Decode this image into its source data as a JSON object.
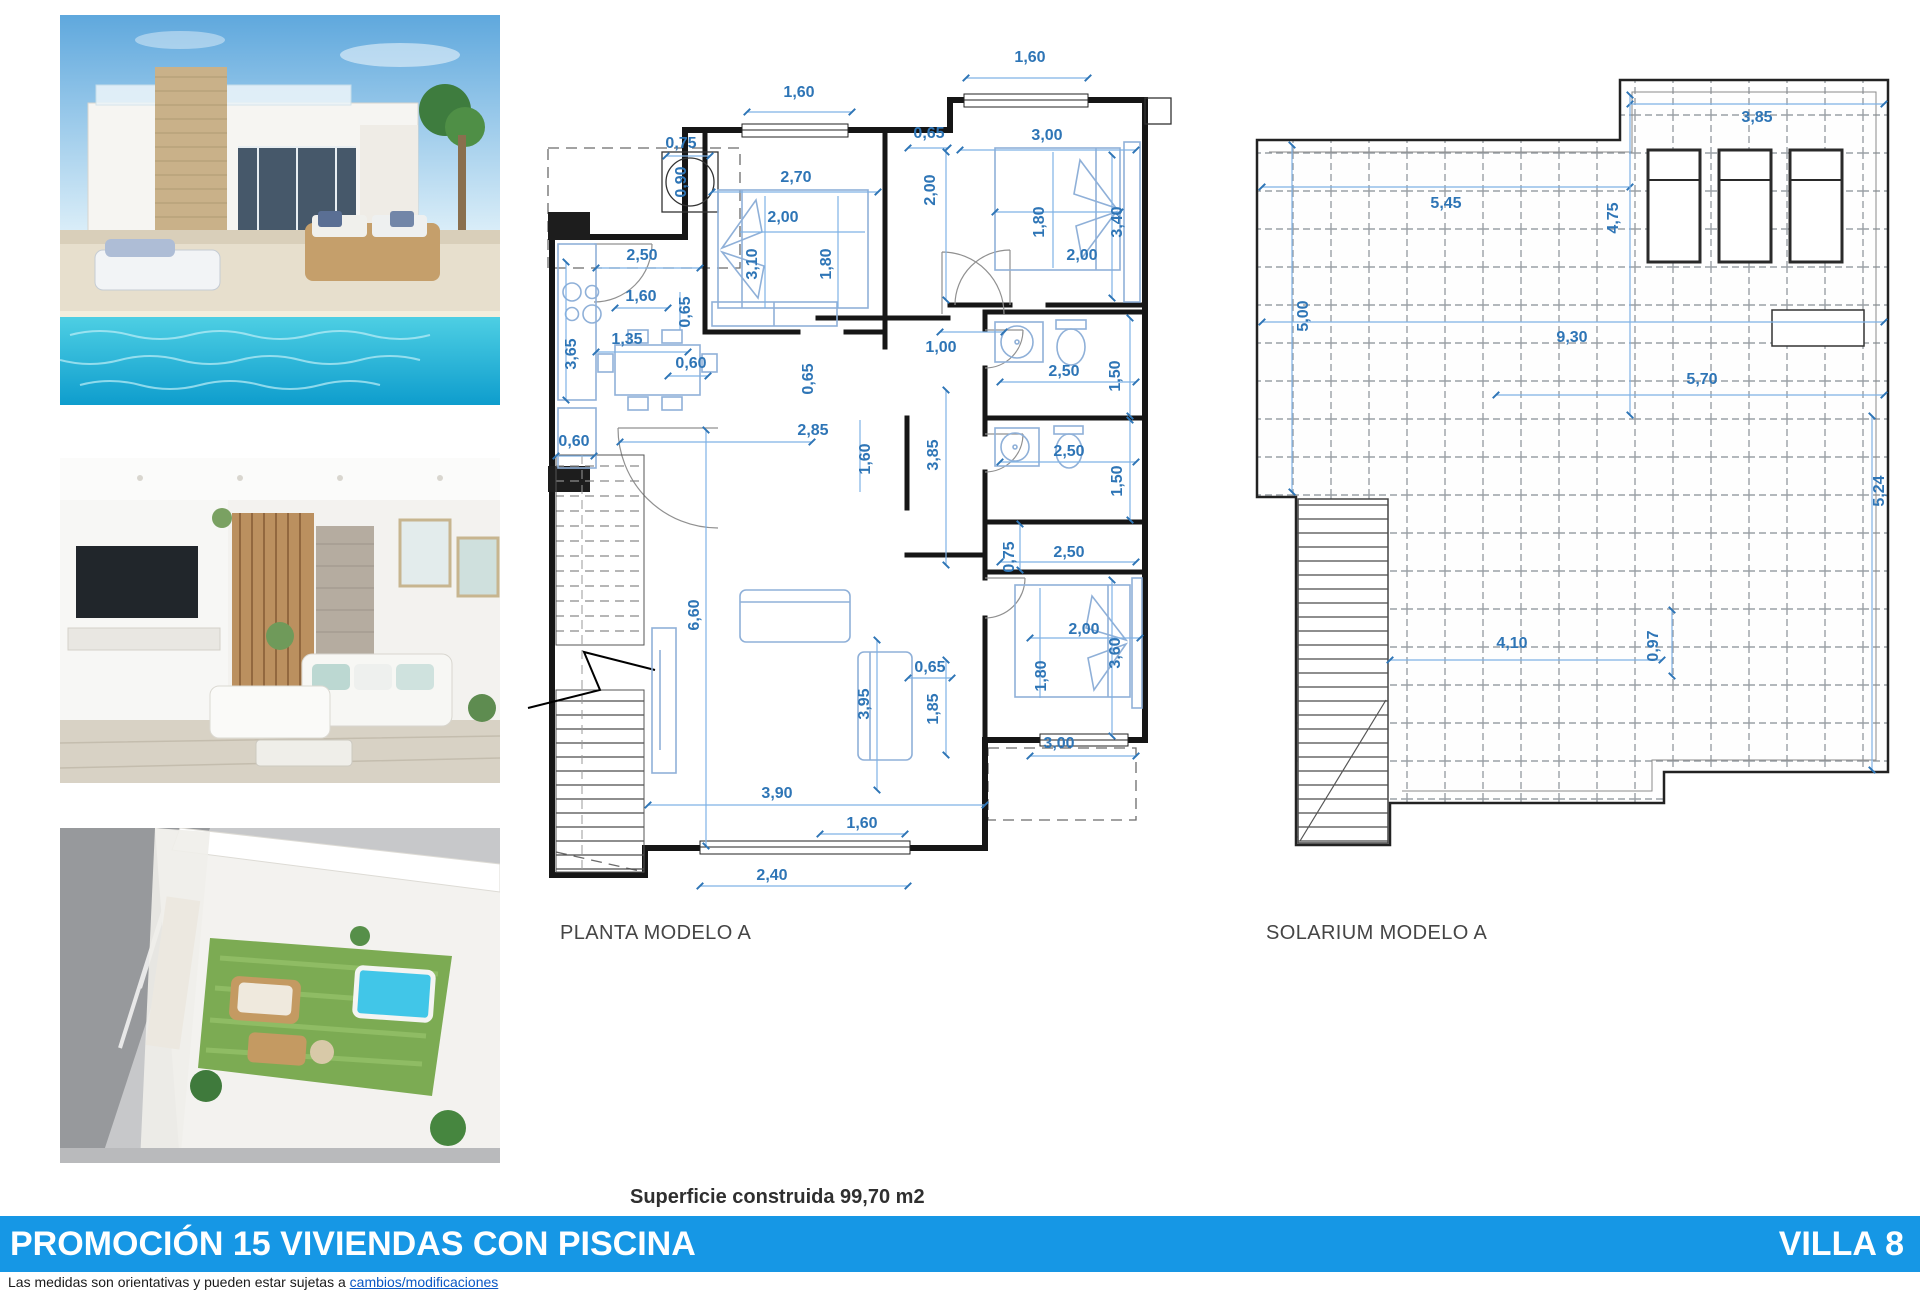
{
  "photos": [
    {
      "name": "villa-exterior-pool-photo"
    },
    {
      "name": "living-room-photo"
    },
    {
      "name": "rooftop-solarium-photo"
    }
  ],
  "planta": {
    "title": "PLANTA MODELO A",
    "dims": [
      {
        "t": "1,60",
        "x": 799,
        "y": 97
      },
      {
        "t": "1,60",
        "x": 1030,
        "y": 62
      },
      {
        "t": "0,75",
        "x": 681,
        "y": 148
      },
      {
        "t": "0,90",
        "x": 686,
        "y": 182,
        "r": -90
      },
      {
        "t": "2,70",
        "x": 796,
        "y": 182
      },
      {
        "t": "0,65",
        "x": 929,
        "y": 138
      },
      {
        "t": "3,00",
        "x": 1047,
        "y": 140
      },
      {
        "t": "2,00",
        "x": 783,
        "y": 222
      },
      {
        "t": "3,10",
        "x": 757,
        "y": 264,
        "r": -90
      },
      {
        "t": "1,80",
        "x": 831,
        "y": 264,
        "r": -90
      },
      {
        "t": "2,00",
        "x": 935,
        "y": 190,
        "r": -90
      },
      {
        "t": "1,80",
        "x": 1044,
        "y": 222,
        "r": -90
      },
      {
        "t": "3,40",
        "x": 1122,
        "y": 222,
        "r": -90
      },
      {
        "t": "2,00",
        "x": 1082,
        "y": 260
      },
      {
        "t": "2,50",
        "x": 642,
        "y": 260
      },
      {
        "t": "1,60",
        "x": 641,
        "y": 301
      },
      {
        "t": "0,65",
        "x": 690,
        "y": 312,
        "r": -90
      },
      {
        "t": "3,65",
        "x": 576,
        "y": 354,
        "r": -90
      },
      {
        "t": "1,35",
        "x": 627,
        "y": 344
      },
      {
        "t": "0,60",
        "x": 691,
        "y": 368
      },
      {
        "t": "1,00",
        "x": 941,
        "y": 352
      },
      {
        "t": "2,50",
        "x": 1064,
        "y": 376
      },
      {
        "t": "1,50",
        "x": 1120,
        "y": 376,
        "r": -90
      },
      {
        "t": "0,65",
        "x": 813,
        "y": 379,
        "r": -90
      },
      {
        "t": "2,85",
        "x": 813,
        "y": 435
      },
      {
        "t": "1,60",
        "x": 870,
        "y": 459,
        "r": -90
      },
      {
        "t": "3,85",
        "x": 938,
        "y": 455,
        "r": -90
      },
      {
        "t": "0,60",
        "x": 574,
        "y": 446
      },
      {
        "t": "2,50",
        "x": 1069,
        "y": 456
      },
      {
        "t": "1,50",
        "x": 1122,
        "y": 481,
        "r": -90
      },
      {
        "t": "6,60",
        "x": 699,
        "y": 615,
        "r": -90
      },
      {
        "t": "0,75",
        "x": 1014,
        "y": 557,
        "r": -90
      },
      {
        "t": "2,50",
        "x": 1069,
        "y": 557
      },
      {
        "t": "2,00",
        "x": 1084,
        "y": 634
      },
      {
        "t": "1,80",
        "x": 1046,
        "y": 676,
        "r": -90
      },
      {
        "t": "3,60",
        "x": 1120,
        "y": 653,
        "r": -90
      },
      {
        "t": "0,65",
        "x": 930,
        "y": 672
      },
      {
        "t": "1,85",
        "x": 938,
        "y": 709,
        "r": -90
      },
      {
        "t": "3,95",
        "x": 869,
        "y": 704,
        "r": -90
      },
      {
        "t": "3,90",
        "x": 777,
        "y": 798
      },
      {
        "t": "3,00",
        "x": 1059,
        "y": 748
      },
      {
        "t": "1,60",
        "x": 862,
        "y": 828
      },
      {
        "t": "2,40",
        "x": 772,
        "y": 880
      }
    ]
  },
  "solarium": {
    "title": "SOLARIUM MODELO A",
    "dims": [
      {
        "t": "3,85",
        "x": 1757,
        "y": 122
      },
      {
        "t": "5,45",
        "x": 1446,
        "y": 208
      },
      {
        "t": "4,75",
        "x": 1618,
        "y": 218,
        "r": -90
      },
      {
        "t": "5,00",
        "x": 1308,
        "y": 316,
        "r": -90
      },
      {
        "t": "9,30",
        "x": 1572,
        "y": 342
      },
      {
        "t": "5,70",
        "x": 1702,
        "y": 384
      },
      {
        "t": "5,24",
        "x": 1884,
        "y": 491,
        "r": -90
      },
      {
        "t": "4,10",
        "x": 1512,
        "y": 648
      },
      {
        "t": "0,97",
        "x": 1658,
        "y": 646,
        "r": -90
      }
    ]
  },
  "surface": {
    "text": "Superficie construida 99,70 m2"
  },
  "banner": {
    "left": "PROMOCIÓN 15 VIVIENDAS CON PISCINA",
    "right": "VILLA 8",
    "bg": "#1697e5"
  },
  "footnote": {
    "text": "Las medidas son orientativas y pueden estar sujetas a ",
    "tail": "cambios/modificaciones"
  },
  "colors": {
    "dim_text": "#2e75b6",
    "dim_line": "#7fb2e5",
    "wall": "#161616",
    "banner": "#1697e5"
  }
}
